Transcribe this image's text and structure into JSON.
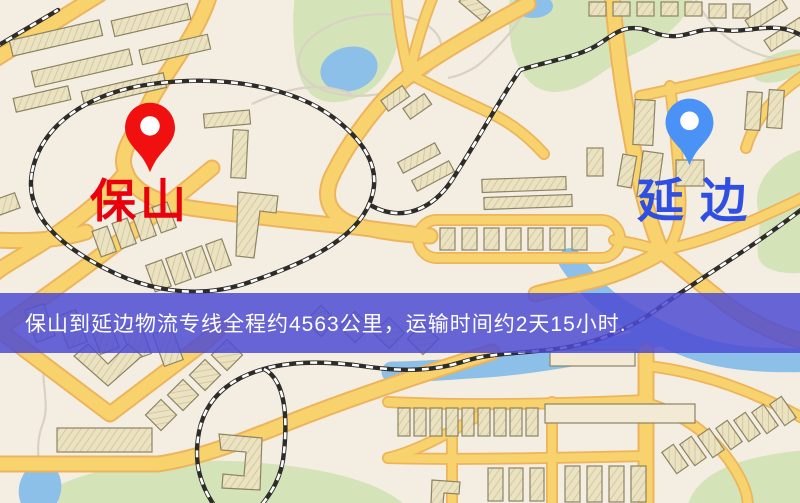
{
  "origin": {
    "label": "保山"
  },
  "destination": {
    "label": "延边"
  },
  "banner": {
    "text": "保山到延边物流专线全程约4563公里，运输时间约2天15小时.",
    "distance_text": "约4563公里",
    "duration_text": "约2天15小时"
  },
  "colors": {
    "map-bg": "#f4eee2",
    "road-fill": "#f8d26d",
    "road-casing": "#edb45c",
    "park": "#d5e3b9",
    "water": "#8cc0e8",
    "bldg-fill": "#ebe2c1",
    "bldg-line": "#8d8463",
    "rail-dark": "#2e2c28",
    "trail": "#d9d2c4",
    "banner-bg": "rgba(77,75,211,0.85)",
    "banner-text": "#ffffff",
    "origin-pin": "#f01010",
    "origin-label": "#e8000d",
    "dest-pin": "#4b92f6",
    "dest-label": "#2f4fe3"
  }
}
